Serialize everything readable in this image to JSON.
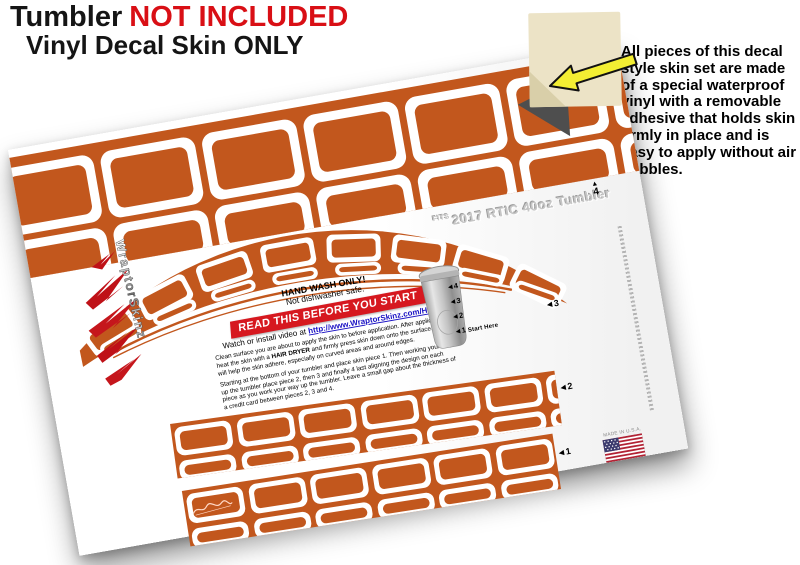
{
  "header": {
    "title_black": "Tumbler",
    "title_red": "NOT INCLUDED",
    "subtitle": "Vinyl Decal Skin ONLY"
  },
  "callout": {
    "text": "All pieces of this decal style skin set are made of a special waterproof vinyl with a removable adhesive that holds skin firmly in place and is easy to apply without air bubbles."
  },
  "sheet": {
    "fits_prefix": "FITS",
    "fits_label": "2017 RTIC 40oz Tumbler",
    "care_line1": "HAND WASH ONLY!",
    "care_line2": "Not dishwasher safe.",
    "banner": "READ THIS BEFORE YOU START",
    "video_prefix": "Watch or install video at ",
    "video_link": "http://www.WraptorSkinz.com/Help",
    "inst1_a": "Clean surface you are about to apply the skin to before application. After application heat the skin with a ",
    "inst1_bold": "HAIR DRYER",
    "inst1_b": " and firmly press skin down onto the surface. This will help the skin adhere, especially on curved areas and around edges.",
    "inst2": "Starting at the bottom of your tumbler and place skin piece 1. Then working your way up the tumbler place piece 2, then 3 and finally 4 last aligning the design on each piece as you work your way up the tumbler. Leave a small gap about the thickness of a credit card between pieces 2, 3 and 4.",
    "markers": {
      "m4_arrow": "▲",
      "m4": "4",
      "m3": "◄3",
      "m2": "◄2",
      "m1": "◄1"
    },
    "legend": {
      "l4": "◄4",
      "l3": "◄3",
      "l2": "◄2",
      "l1": "◄1",
      "note": "Start Here"
    },
    "made_in": "MADE IN U.S.A.",
    "brand": "WraptorSkinz"
  },
  "colors": {
    "orange": "#c2571d",
    "banner_red": "#d6181f",
    "headline_red": "#d90f15",
    "arrow_yellow": "#f3ee33",
    "link_blue": "#1a12c4"
  }
}
